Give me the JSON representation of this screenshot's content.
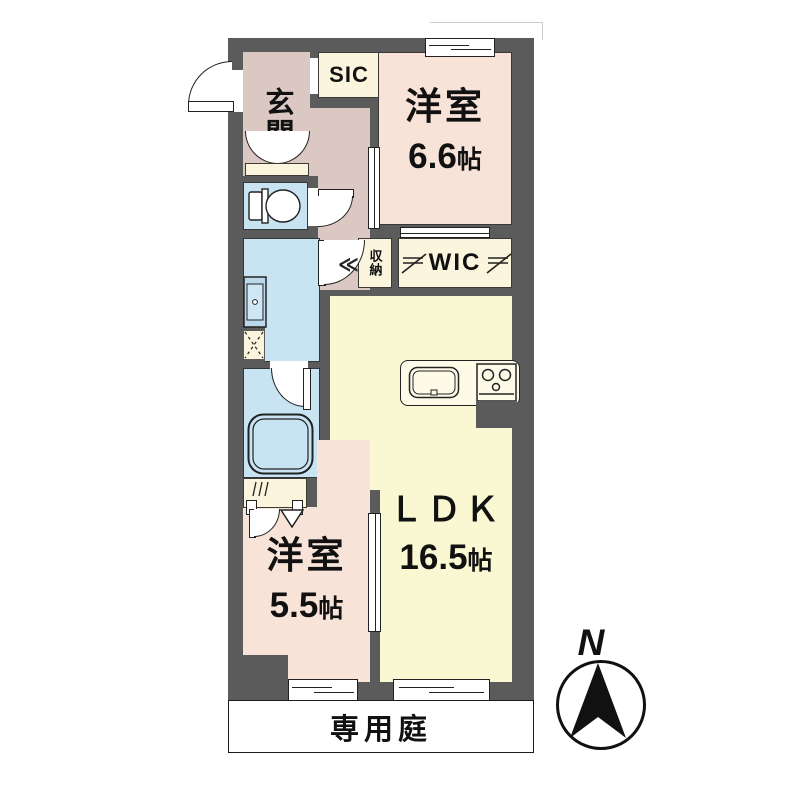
{
  "plan": {
    "rooms": {
      "genkan": {
        "label": "玄関"
      },
      "sic": {
        "label": "SIC"
      },
      "bedroom1": {
        "name": "洋室",
        "size": "6.6",
        "unit": "帖"
      },
      "storage": {
        "label": "収納"
      },
      "wic": {
        "label": "WIC"
      },
      "ldk": {
        "name": "ＬＤＫ",
        "size": "16.5",
        "unit": "帖"
      },
      "bedroom2": {
        "name": "洋室",
        "size": "5.5",
        "unit": "帖"
      },
      "garden": {
        "label": "専用庭"
      }
    },
    "compass": {
      "north_label": "N"
    },
    "colors": {
      "wall": "#5b5b5b",
      "bedroom": "#f8e3d8",
      "entry_hall": "#dcc8c2",
      "ldk": "#f9f8d3",
      "wet_area": "#c8e4f3",
      "closet": "#faf5dc"
    }
  }
}
